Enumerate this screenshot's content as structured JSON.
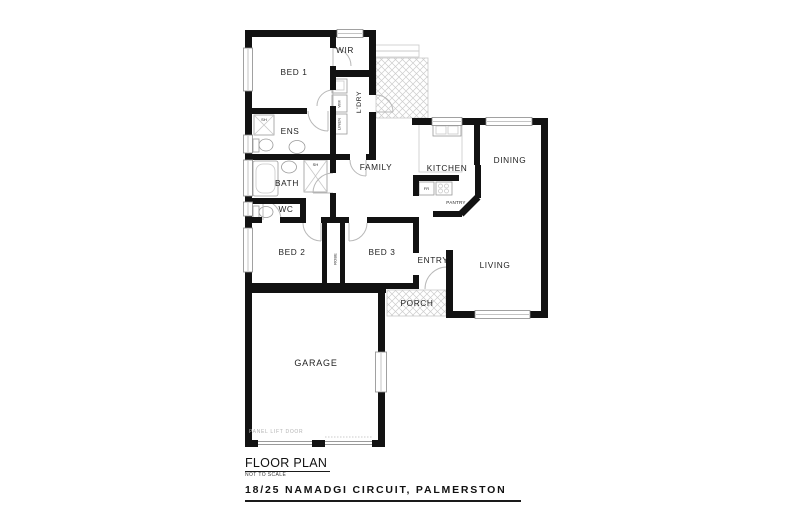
{
  "title_block": {
    "title": "FLOOR PLAN",
    "scale_note": "NOT TO SCALE",
    "address": "18/25 NAMADGI CIRCUIT, PALMERSTON"
  },
  "rooms": {
    "bed1": "BED 1",
    "wir": "WIR",
    "ldry": "L'DRY",
    "wm": "WM",
    "linen": "LINEN",
    "ens": "ENS",
    "ens_shower": "SH",
    "bath": "BATH",
    "bath_shower": "SH",
    "wc": "WC",
    "family": "FAMILY",
    "kitchen": "KITCHEN",
    "fridge": "FR",
    "pantry": "PANTRY",
    "dining": "DINING",
    "bed2": "BED 2",
    "robe": "ROBE",
    "bed3": "BED 3",
    "entry": "ENTRY",
    "living": "LIVING",
    "porch": "PORCH",
    "garage": "GARAGE"
  },
  "annotations": {
    "garage_door": "PANEL LIFT DOOR"
  },
  "colors": {
    "wall": "#121212",
    "fixture": "#9a9a9a",
    "hatch": "#cccccc",
    "text": "#1f1f1f"
  }
}
